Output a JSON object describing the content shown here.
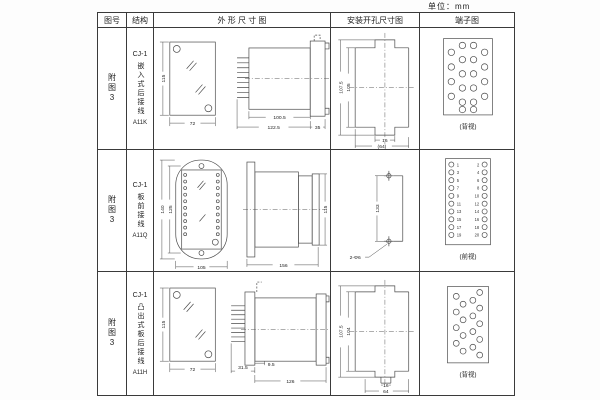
{
  "page": {
    "unit_label": "单位：mm"
  },
  "header": {
    "figure": "图号",
    "structure": "结构",
    "outline": "外 形 尺 寸 图",
    "mounting": "安装开孔尺寸图",
    "terminal": "端子图"
  },
  "rows": [
    {
      "figure": "附图3",
      "model": "CJ-1",
      "structure": "嵌入式后接线",
      "code": "A11K",
      "outline": {
        "height": "115",
        "width": "72",
        "body_len": "100.5",
        "total_len": "122.5",
        "flange": "35"
      },
      "mounting": {
        "outer_h": "107.5",
        "inner_h": "105",
        "slot_w": "16",
        "span_w": "(64)"
      },
      "terminal": {
        "view": "(背视)"
      }
    },
    {
      "figure": "附图3",
      "model": "CJ-1",
      "structure": "板前接线",
      "code": "A11Q",
      "outline": {
        "outer_h": "140",
        "inner_h": "125",
        "width": "105",
        "length": "156",
        "height": "115"
      },
      "mounting": {
        "hole_pitch": "133",
        "holes": "2-Φ6"
      },
      "terminal": {
        "view": "(前视)",
        "left": [
          "1",
          "3",
          "5",
          "7",
          "9",
          "11",
          "13",
          "15",
          "17",
          "19"
        ],
        "right": [
          "2",
          "4",
          "6",
          "8",
          "10",
          "12",
          "14",
          "16",
          "18",
          "20"
        ]
      }
    },
    {
      "figure": "附图3",
      "model": "CJ-1",
      "structure": "凸出式板后接线",
      "code": "A11H",
      "outline": {
        "height": "115",
        "width": "72",
        "front_len": "31.5",
        "offset": "9.5",
        "body_len": "126"
      },
      "mounting": {
        "outer_h": "107.5",
        "inner_h": "104",
        "slot_w": "16",
        "span_w": "64"
      },
      "terminal": {
        "view": "(背视)"
      }
    }
  ]
}
